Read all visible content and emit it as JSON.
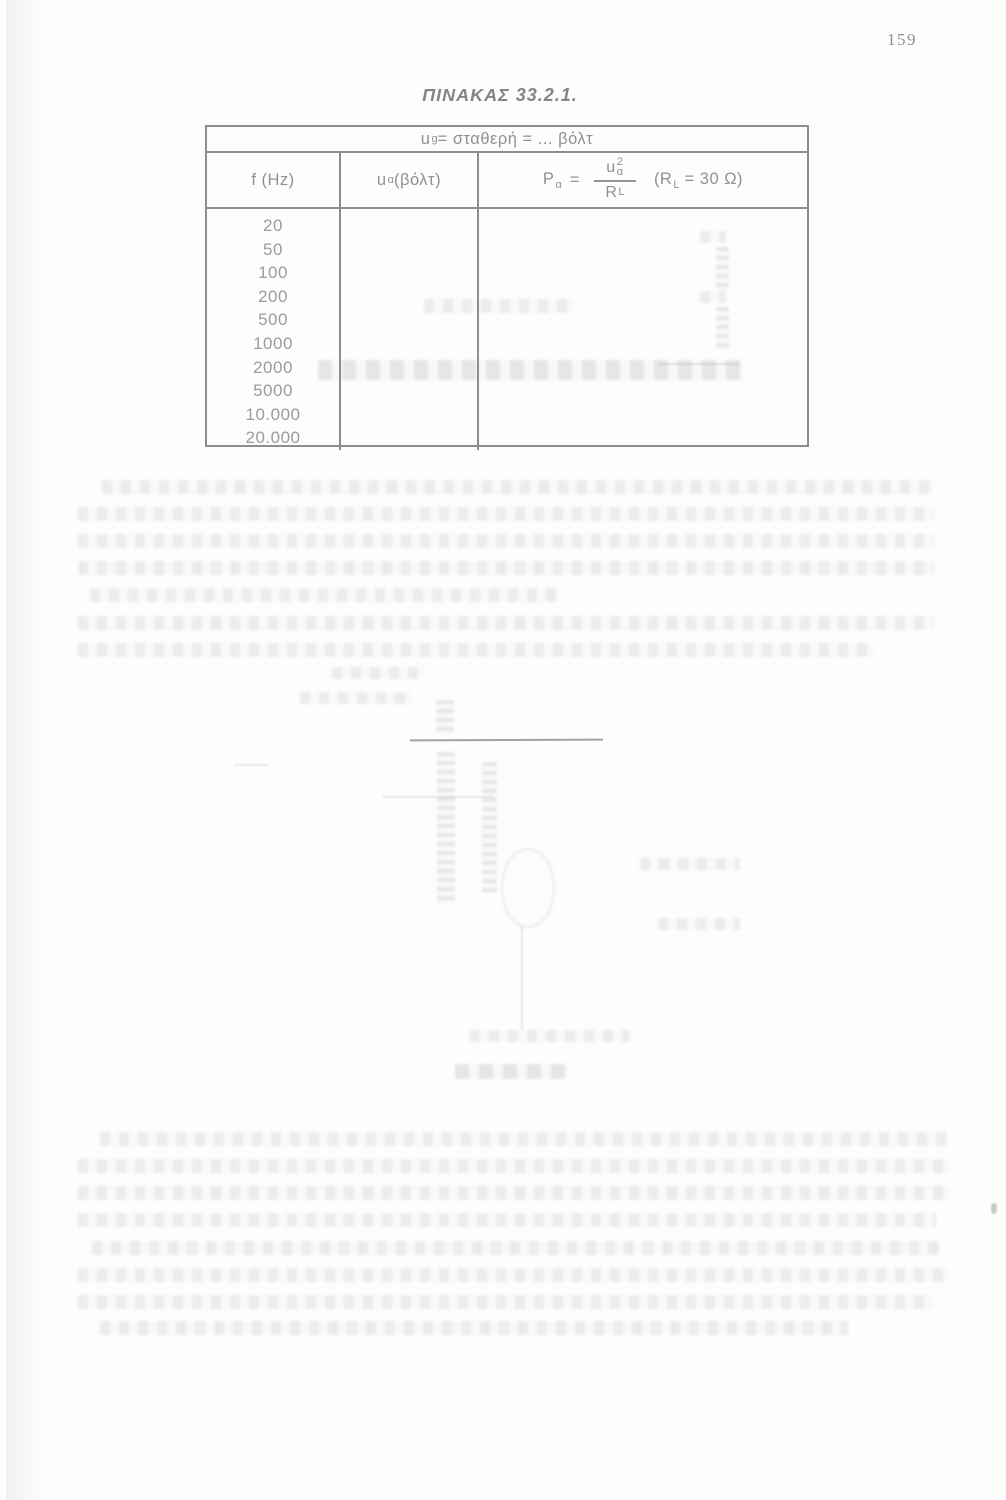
{
  "page": {
    "number": "159"
  },
  "table": {
    "title": "ΠΙΝΑΚΑΣ 33.2.1.",
    "span_header": {
      "var": "u",
      "var_sub": "g",
      "rest": " = σταθερή = ... βόλτ"
    },
    "columns": {
      "col1": "f (Hz)",
      "col2_var": "u",
      "col2_sub": "α",
      "col2_rest": " (βόλτ)",
      "col3": {
        "lhs": "P",
        "lhs_sub": "α",
        "equals": "=",
        "num_var": "u",
        "num_sup": "2",
        "num_sub": "α",
        "den_var": "R",
        "den_sub": "L",
        "cond_open": "(R",
        "cond_sub": "L",
        "cond_rest": " = 30 Ω)"
      }
    },
    "rows": [
      "20",
      "50",
      "100",
      "200",
      "500",
      "1000",
      "2000",
      "5000",
      "10.000",
      "20.000"
    ]
  }
}
